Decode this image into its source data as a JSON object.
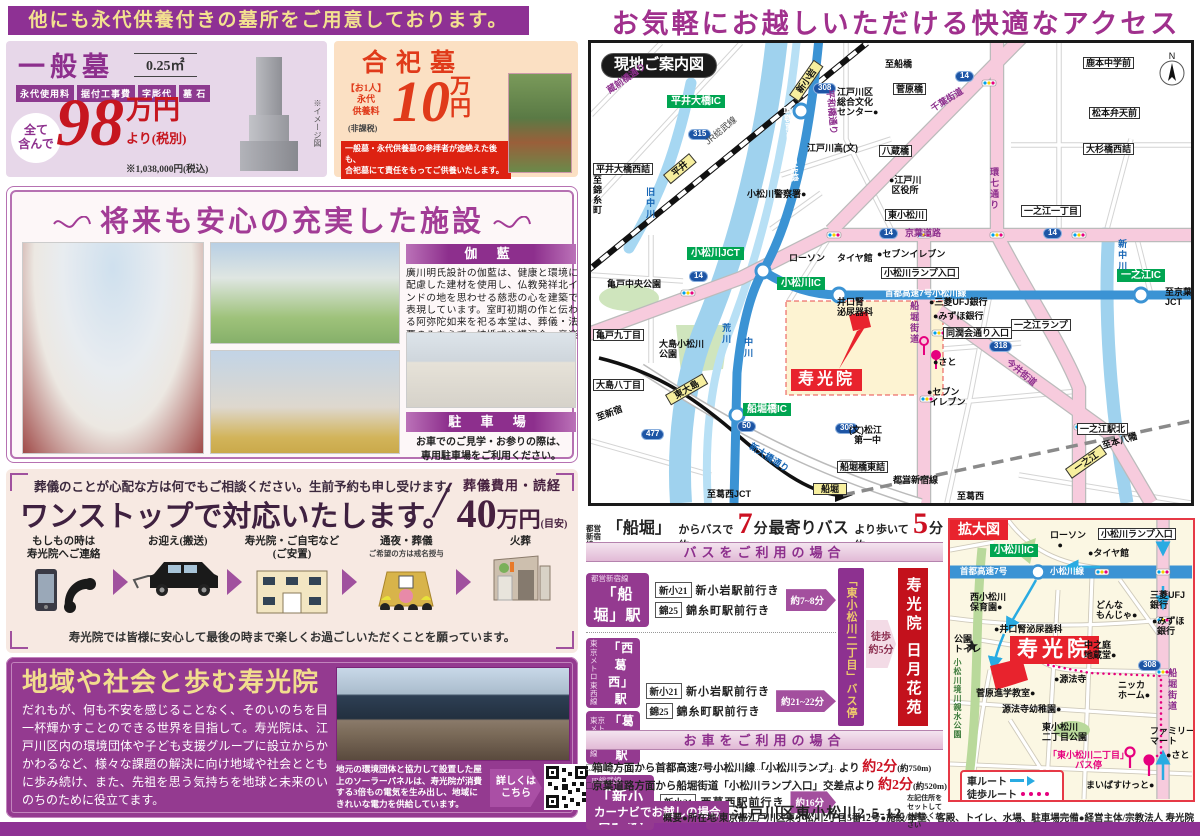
{
  "colors": {
    "purple": "#8e3194",
    "accent_yellow": "#f3e190",
    "price_red": "#c6161f",
    "vermillion": "#e03a1a",
    "map_red": "#e8232d",
    "highway_blue": "#3b93d4",
    "pink_road": "#f7cbdd"
  },
  "page": {
    "banner": "他にも永代供養付きの墓所をご用意しております。",
    "footer_overview": "概要●所在地/東京都江戸川区東小松川2丁目5番12号●施設/本堂、客殿、トイレ、水場、駐車場完備●経営主体/宗教法人 寿光院"
  },
  "general_grave": {
    "title": "一般墓",
    "size": "0.25㎡",
    "badges": [
      "永代使用料",
      "据付工事費",
      "字彫代",
      "墓 石"
    ],
    "all_included": "全て\n含んで",
    "price_number": "98",
    "price_unit": "万円",
    "price_suffix": "より(税別)",
    "tax_note": "※1,038,000円(税込)",
    "image_note": "※イメージ図"
  },
  "communal_grave": {
    "title": "合祀墓",
    "fee_label": "【お1人】\n永代\n供養料",
    "tax_free": "(非課税)",
    "price_number": "10",
    "price_unit_1": "万",
    "price_unit_2": "円",
    "note": "一般墓・永代供養墓の参拝者が途絶えた後も、\n合祀墓にて責任をもってご供養いたします。"
  },
  "facilities": {
    "title": "将来も安心の充実した施設",
    "garan_heading": "伽 藍",
    "garan_text": "廣川明氏設計の伽藍は、健康と環境に配慮した建材を使用し、仏教発祥北インドの地を思わせる慈悲の心を建築で表現しています。室町初期の作と伝わる阿弥陀如来を祀る本堂は、葬儀・法要のみならず、結婚式や講演会、音楽会など多目的に使われています。",
    "parking_heading": "駐 車 場",
    "parking_text": "お車でのご見学・お参りの際は、\n専用駐車場をご利用ください。"
  },
  "funeral": {
    "lead": "葬儀のことが心配な方は何でもご相談ください。生前予約も申し受けます。",
    "title": "ワンストップで対応いたします。",
    "slash": "/",
    "cost_label": "葬儀費用・読経",
    "cost_number": "40",
    "cost_unit": "万円",
    "cost_note": "(目安)",
    "steps": [
      {
        "label": "もしもの時は\n寿光院へご連絡",
        "sub": ""
      },
      {
        "label": "お迎え(搬送)",
        "sub": ""
      },
      {
        "label": "寿光院・ご自宅など\n(ご安置)",
        "sub": ""
      },
      {
        "label": "通夜・葬儀",
        "sub": "ご希望の方は戒名授与"
      },
      {
        "label": "火葬",
        "sub": ""
      }
    ],
    "footer": "寿光院では皆様に安心して最後の時まで楽しくお過ごしいただくことを願っています。"
  },
  "community": {
    "title": "地域や社会と歩む寿光院",
    "body": "だれもが、何も不安を感じることなく、そのいのちを目一杯輝かすことのできる世界を目指して。寿光院は、江戸川区内の環境団体や子ども支援グループに設立からかかわるなど、様々な課題の解決に向け地域や社会とともに歩み続け、また、先祖を思う気持ちを地球と未来のいのちのために役立てます。",
    "photo_caption": "地元の環境団体と協力して設置した屋上のソーラーパネルは、寿光院が消費する3倍もの電気を生み出し、地域にきれいな電力を供給しています。",
    "more_label": "詳しくは\nこちら"
  },
  "access": {
    "title": "お気軽にお越しいただける快適なアクセス",
    "headline": {
      "line_small": "都営\n新宿線",
      "p1": "「船堀」駅",
      "p2": "からバスで約",
      "n1": "7",
      "u1": "分 ",
      "p3": "最寄りバス停",
      "p4": "より歩いて約",
      "n2": "5",
      "u2": "分"
    },
    "bus_title": "バスをご利用の場合",
    "bus_rows": [
      {
        "stations": [
          {
            "line": "都営新宿線",
            "name": "「船堀」駅"
          }
        ],
        "routes": [
          {
            "code": "新小21",
            "dest": "新小岩駅前行き"
          },
          {
            "code": "錦25",
            "dest": "錦糸町駅前行き"
          }
        ],
        "time": "約7~8分"
      },
      {
        "stations": [
          {
            "line": "東京メトロ\n東西線",
            "name": "「西葛西」駅"
          },
          {
            "line": "東京メトロ\n東西線",
            "name": "「葛西」駅"
          }
        ],
        "routes": [
          {
            "code": "新小21",
            "dest": "新小岩駅前行き"
          },
          {
            "code": "錦25",
            "dest": "錦糸町駅前行き"
          }
        ],
        "time": "約21~22分"
      },
      {
        "stations": [
          {
            "line": "JR総武線",
            "name": "「新小岩」駅"
          }
        ],
        "routes": [
          {
            "code": "新小21",
            "dest": "西葛西駅前行き"
          }
        ],
        "time": "約16分"
      }
    ],
    "bus_stop_vertical": "「東小松川二丁目」バス停",
    "walk_badge": "徒歩\n約5分",
    "dest_vertical": "寿光院 日月花苑",
    "car_title": "お車をご利用の場合",
    "car_items": [
      {
        "pre": "□箱崎方面から首都高速7号小松川線「小松川ランプ」より ",
        "time": "約2分",
        "note": "(約750m)"
      },
      {
        "pre": "□京葉道路方面から船堀街道「小松川ランプ入口」交差点より ",
        "time": "約2分",
        "note": "(約520m)"
      }
    ],
    "navi_label": "カーナビでお越しの場合",
    "navi_address": "江戸川区東小松川2-5-12",
    "navi_note": "左記住所をセットして\nお越しください",
    "legend_car": "車ルート",
    "legend_walk": "徒歩ルート"
  },
  "main_map": {
    "labels": [
      {
        "t": "現地ご案内図",
        "x": 10,
        "y": 10,
        "c": "titlebox"
      },
      {
        "t": "平井大橋IC",
        "x": 76,
        "y": 52,
        "c": "green"
      },
      {
        "t": "315",
        "x": 97,
        "y": 86,
        "c": "shield"
      },
      {
        "t": "平井大橋西詰",
        "x": 2,
        "y": 120,
        "c": "box"
      },
      {
        "t": "蔵前橋通り",
        "x": 14,
        "y": 44,
        "c": "roadp",
        "r": -35
      },
      {
        "t": "JR総武線",
        "x": 112,
        "y": 96,
        "c": "grey",
        "r": -40
      },
      {
        "t": "平井",
        "x": 72,
        "y": 132,
        "c": "station",
        "r": -40
      },
      {
        "t": "新小岩",
        "x": 198,
        "y": 52,
        "c": "station",
        "r": -55
      },
      {
        "t": "至船橋",
        "x": 294,
        "y": 16
      },
      {
        "t": "308",
        "x": 222,
        "y": 40,
        "c": "shield"
      },
      {
        "t": "平和橋通り",
        "x": 244,
        "y": 46,
        "c": "roadp",
        "r": 85
      },
      {
        "t": "江戸川区\n総合文化\nセンター●",
        "x": 246,
        "y": 44
      },
      {
        "t": "菅原橋",
        "x": 302,
        "y": 40,
        "c": "box"
      },
      {
        "t": "千葉街道",
        "x": 338,
        "y": 62,
        "c": "roadp",
        "r": -32
      },
      {
        "t": "14",
        "x": 364,
        "y": 28,
        "c": "shield"
      },
      {
        "t": "鹿本中学前",
        "x": 492,
        "y": 14,
        "c": "box"
      },
      {
        "t": "松本弁天前",
        "x": 498,
        "y": 64,
        "c": "box"
      },
      {
        "t": "大杉橋西詰",
        "x": 492,
        "y": 100,
        "c": "box"
      },
      {
        "t": "八蔵橋",
        "x": 288,
        "y": 102,
        "c": "box"
      },
      {
        "t": "江戸川高(文)",
        "x": 216,
        "y": 100
      },
      {
        "t": "●江戸川\n 区役所",
        "x": 298,
        "y": 132
      },
      {
        "t": "東小松川",
        "x": 294,
        "y": 166,
        "c": "box"
      },
      {
        "t": "環七通り",
        "x": 398,
        "y": 124,
        "c": "roadv"
      },
      {
        "t": "一之江一丁目",
        "x": 430,
        "y": 162,
        "c": "box"
      },
      {
        "t": "京葉道路",
        "x": 314,
        "y": 185,
        "c": "roadp"
      },
      {
        "t": "14",
        "x": 288,
        "y": 185,
        "c": "shield"
      },
      {
        "t": "14",
        "x": 452,
        "y": 185,
        "c": "shield"
      },
      {
        "t": "14",
        "x": 98,
        "y": 228,
        "c": "shield"
      },
      {
        "t": "小松川警察署●",
        "x": 156,
        "y": 146
      },
      {
        "t": "旧中川",
        "x": 54,
        "y": 144,
        "c": "bluev"
      },
      {
        "t": "至\n錦\n糸\n町",
        "x": 2,
        "y": 132
      },
      {
        "t": "亀戸中央公園",
        "x": 16,
        "y": 236
      },
      {
        "t": "小松川JCT",
        "x": 96,
        "y": 204,
        "c": "green"
      },
      {
        "t": "亀戸九丁目",
        "x": 2,
        "y": 286,
        "c": "box"
      },
      {
        "t": "首都高速中央環状線",
        "x": 200,
        "y": 62,
        "c": "wob",
        "r": 84
      },
      {
        "t": "小松川IC",
        "x": 186,
        "y": 234,
        "c": "green"
      },
      {
        "t": "首都高速7号小松川線",
        "x": 294,
        "y": 246,
        "c": "wob"
      },
      {
        "t": "一之江IC",
        "x": 526,
        "y": 226,
        "c": "green"
      },
      {
        "t": "一之江ランプ",
        "x": 420,
        "y": 276,
        "c": "box"
      },
      {
        "t": "至京葉\nJCT",
        "x": 574,
        "y": 244
      },
      {
        "t": "新中川",
        "x": 526,
        "y": 196,
        "c": "bluev"
      },
      {
        "t": "ローソン",
        "x": 198,
        "y": 210
      },
      {
        "t": "タイヤ館",
        "x": 246,
        "y": 210
      },
      {
        "t": "●セブンイレブン",
        "x": 286,
        "y": 206
      },
      {
        "t": "小松川ランプ入口",
        "x": 290,
        "y": 224,
        "c": "box"
      },
      {
        "t": "井口腎\n泌尿器科",
        "x": 246,
        "y": 254
      },
      {
        "t": "船堀街道",
        "x": 318,
        "y": 258,
        "c": "roadv"
      },
      {
        "t": "●三菱UFJ銀行",
        "x": 338,
        "y": 254
      },
      {
        "t": "●みずほ銀行",
        "x": 342,
        "y": 268
      },
      {
        "t": "同潤会通り入口",
        "x": 352,
        "y": 284,
        "c": "box"
      },
      {
        "t": "●さと",
        "x": 342,
        "y": 314
      },
      {
        "t": "●セブン\n イレブン",
        "x": 336,
        "y": 344
      },
      {
        "t": "今井街道",
        "x": 420,
        "y": 314,
        "c": "roadp",
        "r": 40
      },
      {
        "t": "318",
        "x": 398,
        "y": 298,
        "c": "shield"
      },
      {
        "t": "寿光院",
        "x": 200,
        "y": 326,
        "c": "redbig"
      },
      {
        "t": "大島小松川\n公園",
        "x": 68,
        "y": 296
      },
      {
        "t": "大島八丁目",
        "x": 2,
        "y": 336,
        "c": "box"
      },
      {
        "t": "至新宿",
        "x": 4,
        "y": 370,
        "r": -20
      },
      {
        "t": "東大島",
        "x": 74,
        "y": 352,
        "c": "station",
        "r": -30
      },
      {
        "t": "477",
        "x": 50,
        "y": 386,
        "c": "shield"
      },
      {
        "t": "船堀橋IC",
        "x": 152,
        "y": 360,
        "c": "green"
      },
      {
        "t": "新大橋通り",
        "x": 162,
        "y": 398,
        "c": "bluer",
        "r": 33
      },
      {
        "t": "50",
        "x": 146,
        "y": 378,
        "c": "shield"
      },
      {
        "t": "308",
        "x": 244,
        "y": 380,
        "c": "shield"
      },
      {
        "t": "(文)松江\n  第一中",
        "x": 258,
        "y": 382
      },
      {
        "t": "船堀橋東詰",
        "x": 246,
        "y": 418,
        "c": "box"
      },
      {
        "t": "都営新宿線",
        "x": 302,
        "y": 432
      },
      {
        "t": "船堀",
        "x": 222,
        "y": 440,
        "c": "station"
      },
      {
        "t": "至葛西JCT",
        "x": 116,
        "y": 446
      },
      {
        "t": "至葛西",
        "x": 366,
        "y": 448
      },
      {
        "t": "一之江駅北",
        "x": 486,
        "y": 380,
        "c": "box"
      },
      {
        "t": "至本八幡",
        "x": 510,
        "y": 398,
        "r": -16
      },
      {
        "t": "一之江",
        "x": 474,
        "y": 426,
        "c": "station",
        "r": -35
      },
      {
        "t": "荒川",
        "x": 130,
        "y": 280,
        "c": "bluev"
      },
      {
        "t": "中川",
        "x": 152,
        "y": 294,
        "c": "bluev"
      }
    ]
  },
  "zoom_map": {
    "labels": [
      {
        "t": "拡大図",
        "x": 0,
        "y": 0,
        "c": "redbox"
      },
      {
        "t": "小松川IC",
        "x": 40,
        "y": 24,
        "c": "green"
      },
      {
        "t": "ローソン\n   ●",
        "x": 100,
        "y": 10
      },
      {
        "t": "●タイヤ館",
        "x": 138,
        "y": 28
      },
      {
        "t": "小松川ランプ入口",
        "x": 148,
        "y": 8,
        "c": "box"
      },
      {
        "t": "首都高速7号",
        "x": 10,
        "y": 47,
        "c": "wob"
      },
      {
        "t": "小松川線",
        "x": 100,
        "y": 47,
        "c": "wob"
      },
      {
        "t": "西小松川\n保育園●",
        "x": 20,
        "y": 72
      },
      {
        "t": "どんな\nもんじゃ●",
        "x": 146,
        "y": 80
      },
      {
        "t": "三菱UFJ\n銀行",
        "x": 200,
        "y": 70
      },
      {
        "t": "●みずほ\n  銀行",
        "x": 202,
        "y": 96
      },
      {
        "t": "●井口腎泌尿器科",
        "x": 44,
        "y": 104
      },
      {
        "t": "公園\nトイレ",
        "x": 4,
        "y": 114
      },
      {
        "t": "寿光院",
        "x": 60,
        "y": 116,
        "c": "redbig lg"
      },
      {
        "t": "中之庭\n地蔵堂●",
        "x": 134,
        "y": 120
      },
      {
        "t": "308",
        "x": 188,
        "y": 140,
        "c": "shield"
      },
      {
        "t": "小松川境川親水公園",
        "x": 2,
        "y": 138,
        "c": "grnv"
      },
      {
        "t": "●源法寺",
        "x": 104,
        "y": 154
      },
      {
        "t": "菅原進学教室●",
        "x": 26,
        "y": 168
      },
      {
        "t": "源法寺幼稚園●",
        "x": 52,
        "y": 184
      },
      {
        "t": "ニッカ\nホーム●",
        "x": 168,
        "y": 160
      },
      {
        "t": "船堀街道",
        "x": 217,
        "y": 148,
        "c": "roadv"
      },
      {
        "t": "東小松川\n二丁目公園",
        "x": 92,
        "y": 202
      },
      {
        "t": "ファミリー\nマート",
        "x": 200,
        "y": 206
      },
      {
        "t": "「東小松川二丁目」\nバス停",
        "x": 98,
        "y": 230,
        "c": "pinktxt"
      },
      {
        "t": "●さと",
        "x": 216,
        "y": 230
      },
      {
        "t": "まいばすけっと●",
        "x": 136,
        "y": 260
      }
    ]
  }
}
